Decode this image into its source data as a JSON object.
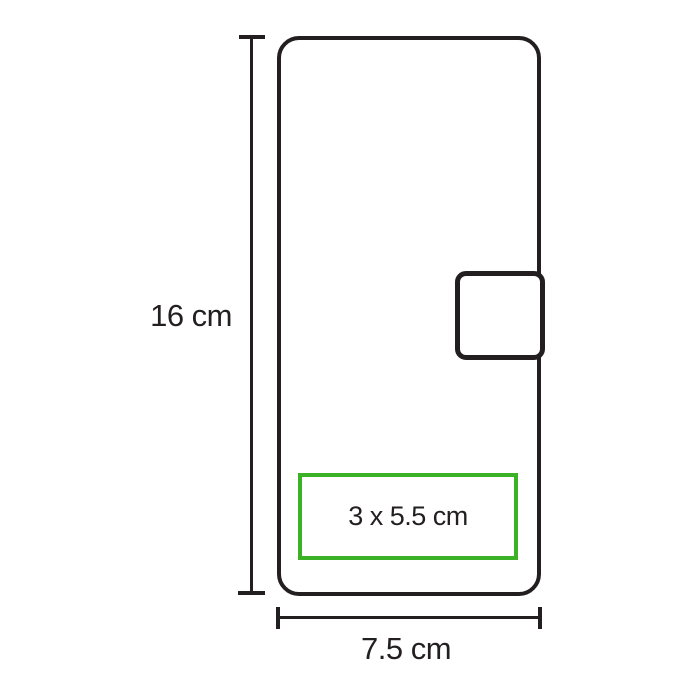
{
  "diagram": {
    "kind": "product-dimension-diagram",
    "product_shape": "wallet-case-with-clasp",
    "labels": {
      "height": "16 cm",
      "width": "7.5 cm",
      "imprint_area": "3 x 5.5 cm"
    },
    "dimensions": {
      "height_cm": 16,
      "width_cm": 7.5,
      "imprint_area_cm": "3 x 5.5"
    },
    "colors": {
      "outline": "#231f20",
      "imprint_border": "#3bb226",
      "text": "#231f20",
      "background": "#ffffff"
    }
  }
}
